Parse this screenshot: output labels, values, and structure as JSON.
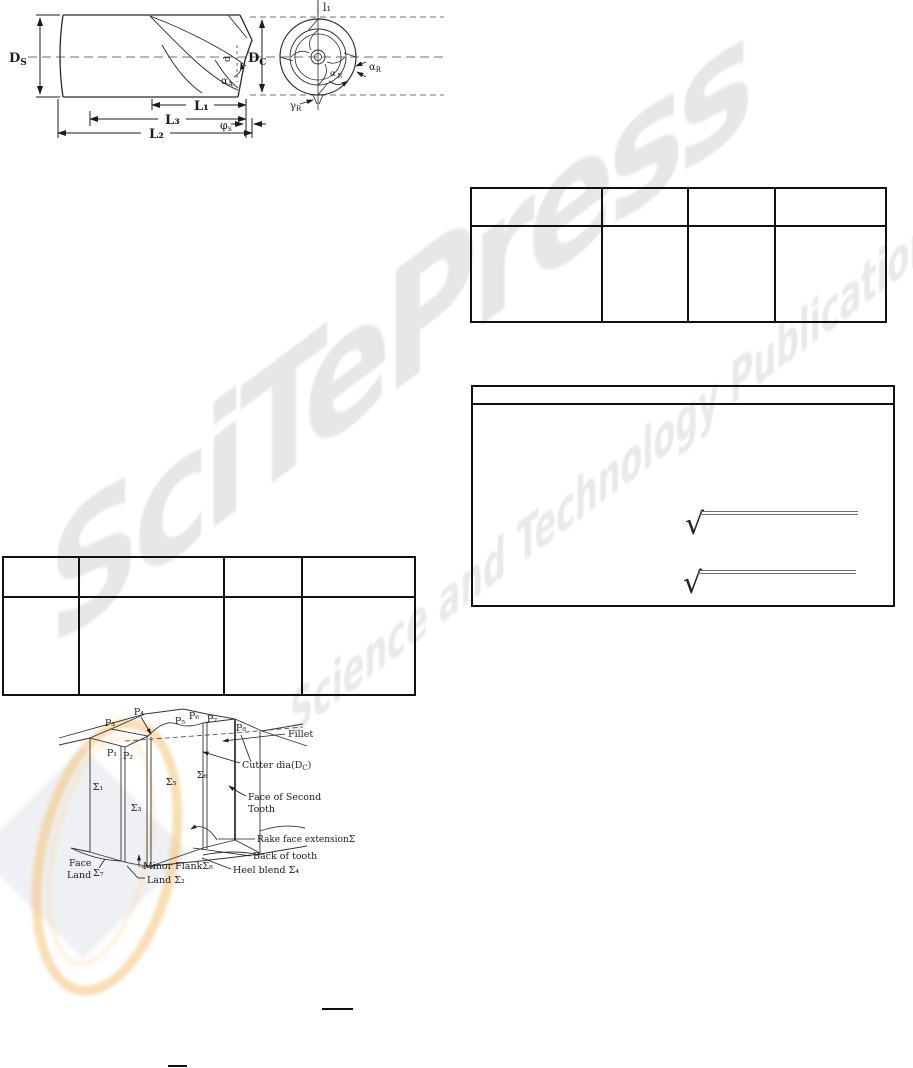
{
  "watermark": {
    "brand": "SciTePress",
    "tagline": "Science and Technology Publications",
    "text_color": "#e7e7ea",
    "logo_orange": "#f4c47a"
  },
  "endmill_figure": {
    "ds_base": "D",
    "ds_sub": "S",
    "dc_base": "D",
    "dc_sub": "C",
    "l1": "L₁",
    "l3": "L₃",
    "l2": "L₂",
    "phi_base": "φ",
    "phi_sub": "s",
    "d_tip": "d",
    "alpha_a_base": "α",
    "alpha_a_sub": "A",
    "front_l1": "l₁",
    "alpha_r_base": "α",
    "alpha_r_sub": "R",
    "alpha_rp_base": "α′",
    "alpha_rp_sub": "R",
    "gamma_r_base": "γ",
    "gamma_r_sub": "R"
  },
  "tooth_figure": {
    "p1": "P₁",
    "p2": "P₂",
    "p3": "P₃",
    "p4": "P₄",
    "p5": "P₅",
    "p6": "P₆",
    "p7": "P₇",
    "p8": "P₈",
    "s1": "Σ₁",
    "s3": "Σ₃",
    "s5": "Σ₅",
    "s6": "Σ₆",
    "fillet": "Fillet",
    "cutter_dia_base": "Cutter dia(D",
    "cutter_dia_sub": "C",
    "cutter_dia_close": ")",
    "face_second_1": "Face of Second",
    "face_second_2": "Tooth",
    "rake_ext": "Rake face extension",
    "rake_ext_sigma": "Σ₉",
    "back_tooth": "Back of tooth",
    "heel_blend": "Heel blend ",
    "heel_sigma": "Σ₄",
    "minor_flank": "Minor Flank",
    "minor_sigma": "Σ₈",
    "land": "Land ",
    "land_sigma": "Σ₂",
    "face_land_1": "Face",
    "face_land_2": "Land",
    "face_land_sigma": "Σ₇"
  },
  "formulas": {
    "sqrt": "√"
  }
}
